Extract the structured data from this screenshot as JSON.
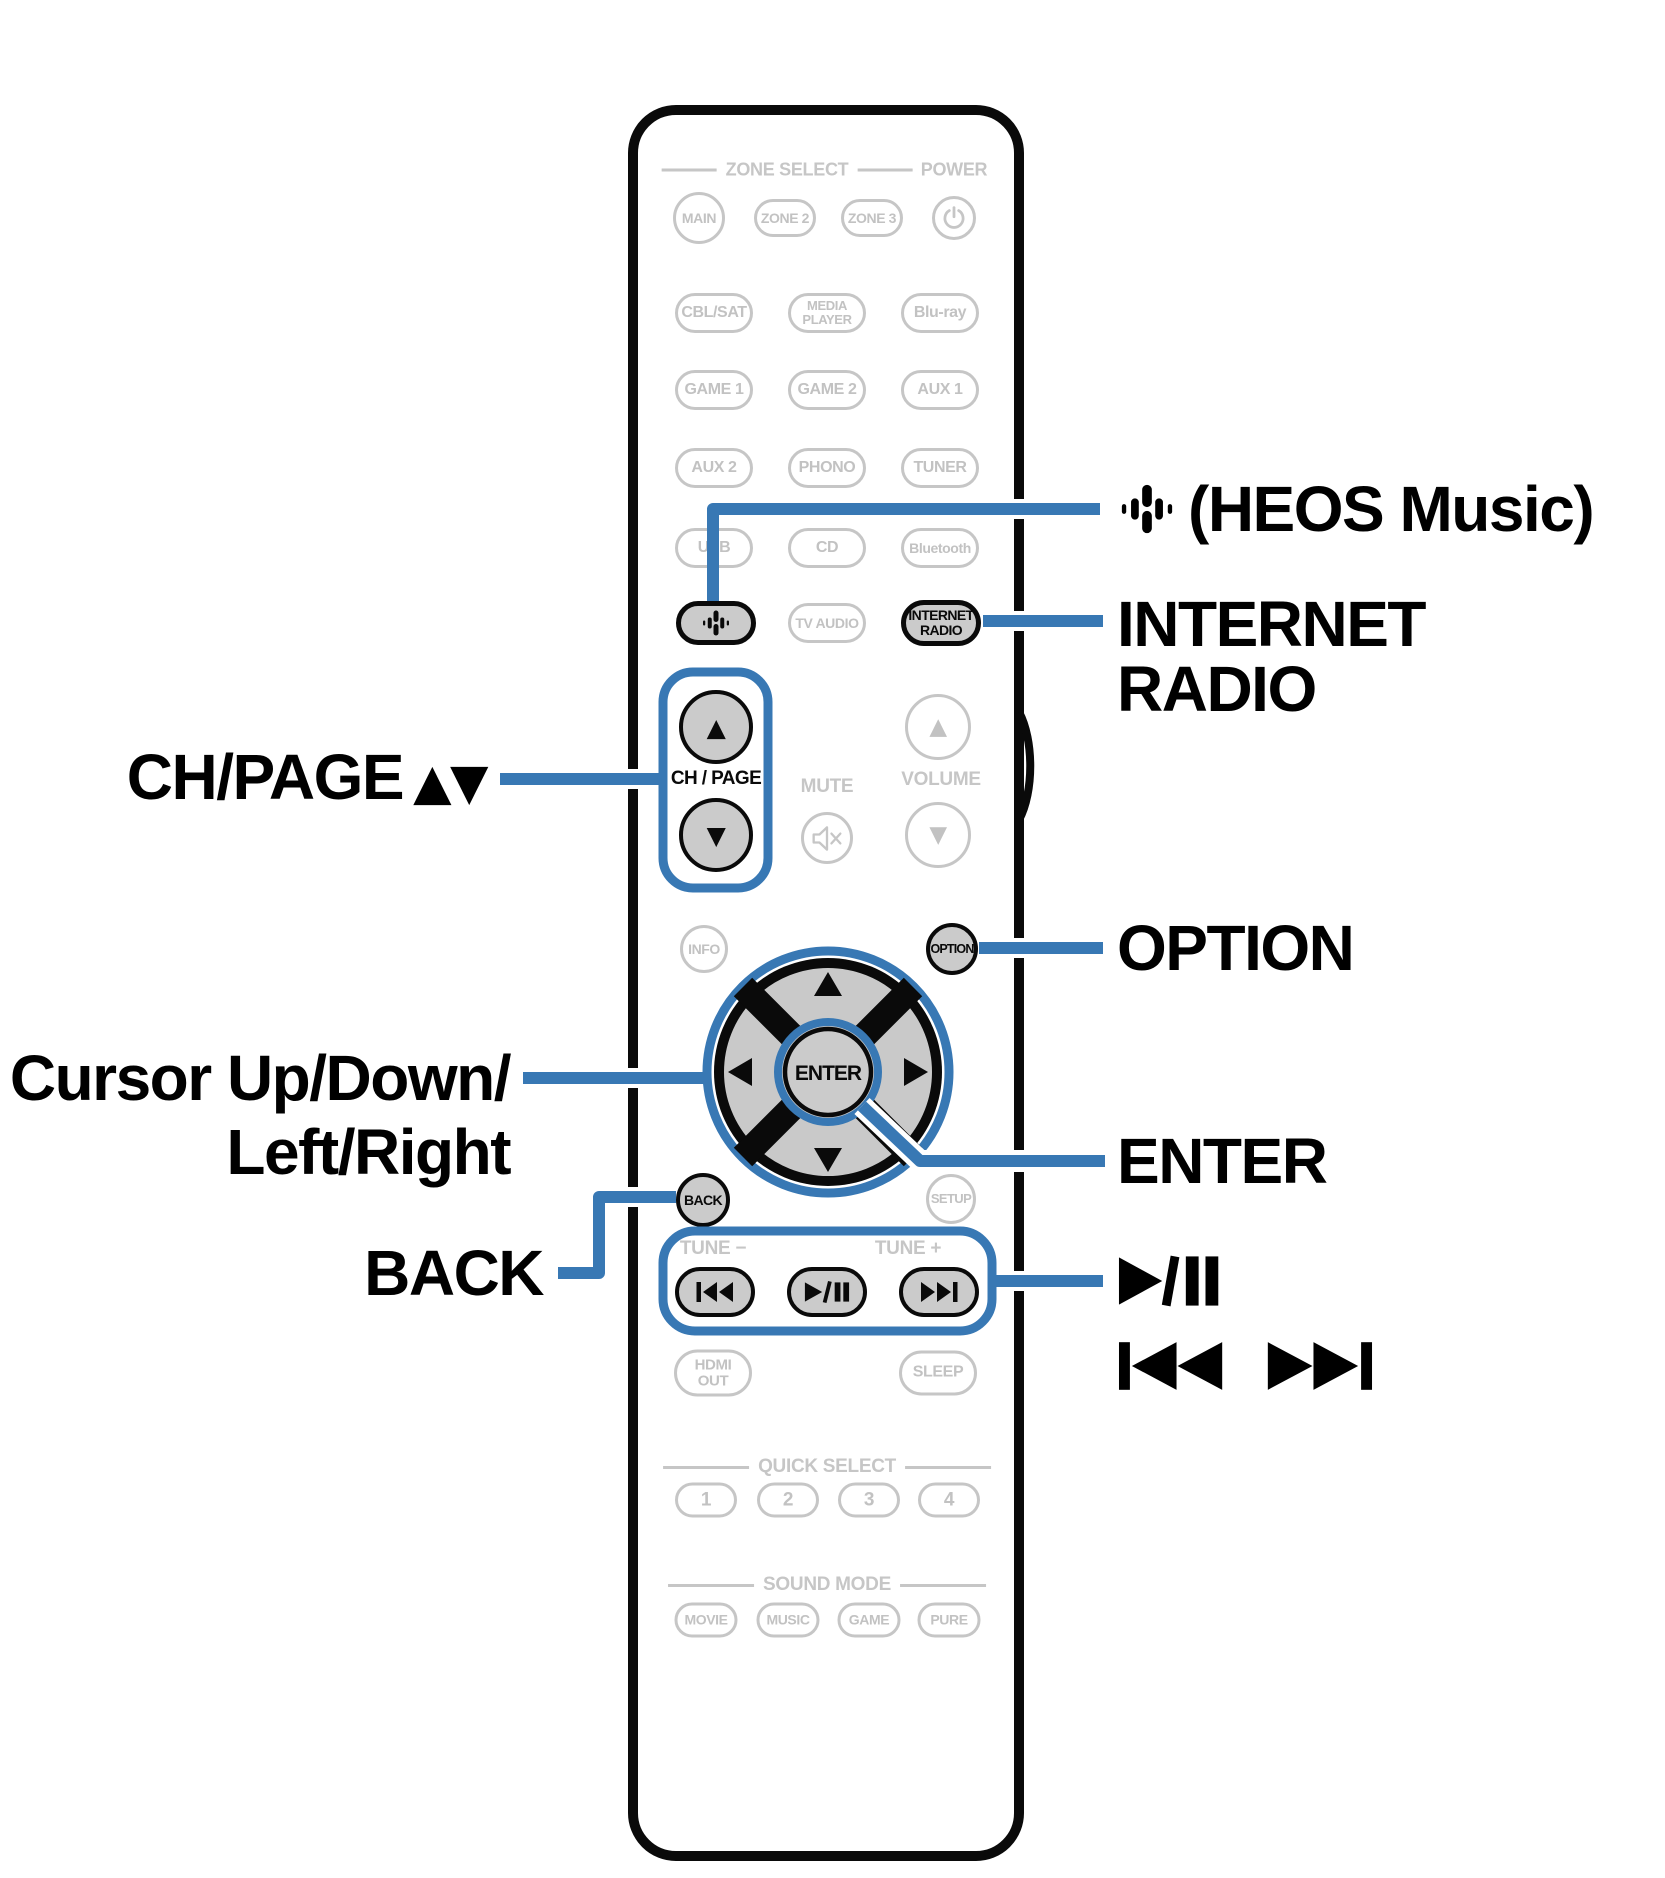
{
  "colors": {
    "blue": "#3878b4",
    "gray": "#c6c6c6",
    "graytext": "#c2c2c2",
    "key_fill": "#cbcbcb",
    "ink": "#0a0a0a"
  },
  "remote": {
    "zone_select_label": "ZONE SELECT",
    "power_label": "POWER",
    "zones": {
      "main": "MAIN",
      "zone2": "ZONE 2",
      "zone3": "ZONE 3"
    },
    "inputs": {
      "cbl_sat": "CBL/SAT",
      "media_player_1": "MEDIA",
      "media_player_2": "PLAYER",
      "blu_ray": "Blu-ray",
      "game1": "GAME 1",
      "game2": "GAME 2",
      "aux1": "AUX 1",
      "aux2": "AUX 2",
      "phono": "PHONO",
      "tuner": "TUNER",
      "usb": "USB",
      "cd": "CD",
      "bluetooth": "Bluetooth",
      "tv_audio": "TV AUDIO",
      "internet_radio_1": "INTERNET",
      "internet_radio_2": "RADIO"
    },
    "arrow_up": "▲",
    "arrow_down": "▼",
    "ch_page_label": "CH / PAGE",
    "mute_label": "MUTE",
    "volume_label": "VOLUME",
    "info_label": "INFO",
    "option_label": "OPTION",
    "enter_label": "ENTER",
    "back_label": "BACK",
    "setup_label": "SETUP",
    "tune_minus": "TUNE −",
    "tune_plus": "TUNE +",
    "hdmi_1": "HDMI",
    "hdmi_2": "OUT",
    "sleep_label": "SLEEP",
    "quick_select_label": "QUICK SELECT",
    "quick_buttons": [
      "1",
      "2",
      "3",
      "4"
    ],
    "sound_mode_label": "SOUND MODE",
    "sound_buttons": [
      "MOVIE",
      "MUSIC",
      "GAME",
      "PURE"
    ]
  },
  "callouts": {
    "heos_music": "(HEOS Music)",
    "internet_radio_1": "INTERNET",
    "internet_radio_2": "RADIO",
    "ch_page": "CH/PAGE",
    "ch_page_arrows": "▲▼",
    "option": "OPTION",
    "cursor_1": "Cursor Up/Down/",
    "cursor_2": "Left/Right",
    "enter": "ENTER",
    "back": "BACK",
    "icons": {
      "play_pause": "play-pause-icon",
      "skip": "skip-back-forward-icons",
      "heos": "heos-icon"
    }
  }
}
